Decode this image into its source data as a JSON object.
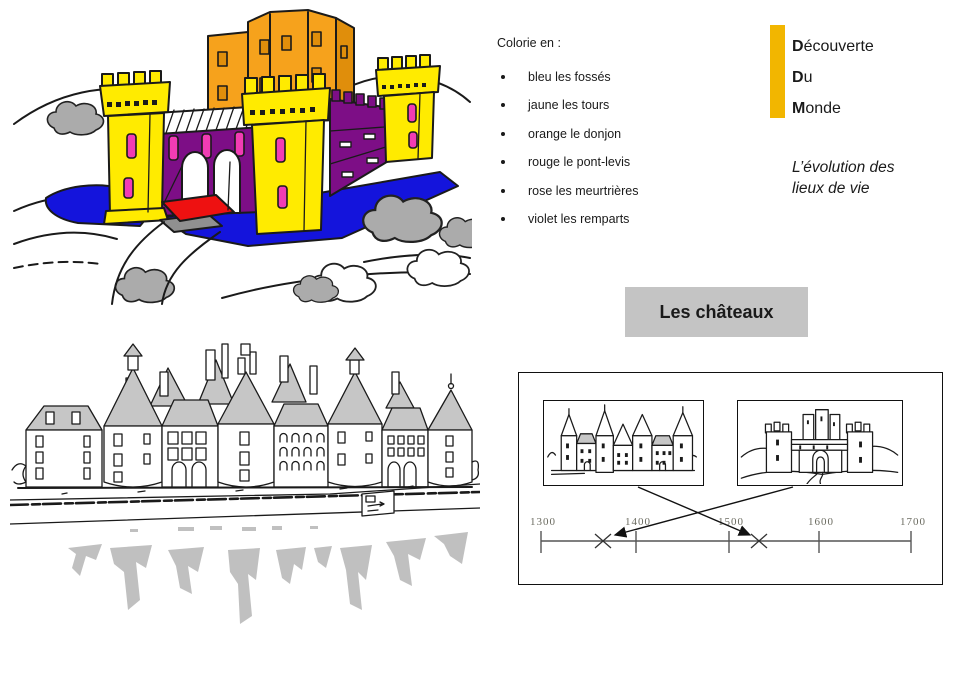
{
  "page": {
    "width": 962,
    "height": 681,
    "background": "#ffffff"
  },
  "coloring": {
    "title": "Colorie en :",
    "items": [
      "bleu les fossés",
      "jaune les tours",
      "orange le donjon",
      "rouge le pont-levis",
      "rose les meurtrières",
      "violet les remparts"
    ]
  },
  "brand": {
    "lines": [
      {
        "initial": "D",
        "rest": "écouverte"
      },
      {
        "initial": "D",
        "rest": "u"
      },
      {
        "initial": "M",
        "rest": "onde"
      }
    ],
    "subtitle_line1": "L’évolution des",
    "subtitle_line2": "lieux de vie"
  },
  "section": {
    "title": "Les châteaux"
  },
  "timeline": {
    "ticks": [
      "1300",
      "1400",
      "1500",
      "1600",
      "1700"
    ],
    "range": [
      1300,
      1700
    ],
    "marks": [
      {
        "approx_year": 1365,
        "linked_image": "medieval-castle-sketch"
      },
      {
        "approx_year": 1533,
        "linked_image": "renaissance-chateau-sketch"
      }
    ]
  },
  "colors": {
    "accent_yellow": "#F2B600",
    "castle_yellow": "#FFEB00",
    "castle_orange": "#F6A21C",
    "castle_orange_dark": "#E08E0B",
    "castle_purple": "#7D0E86",
    "castle_blue": "#1414DC",
    "castle_red": "#EE1111",
    "castle_pink": "#F23CB4",
    "sketch_gray": "#ABABAB",
    "roof_gray": "#C6C6C6",
    "reflection_gray": "#C0C0C0",
    "section_box_gray": "#C4C4C4",
    "ink": "#1A1A1A"
  }
}
